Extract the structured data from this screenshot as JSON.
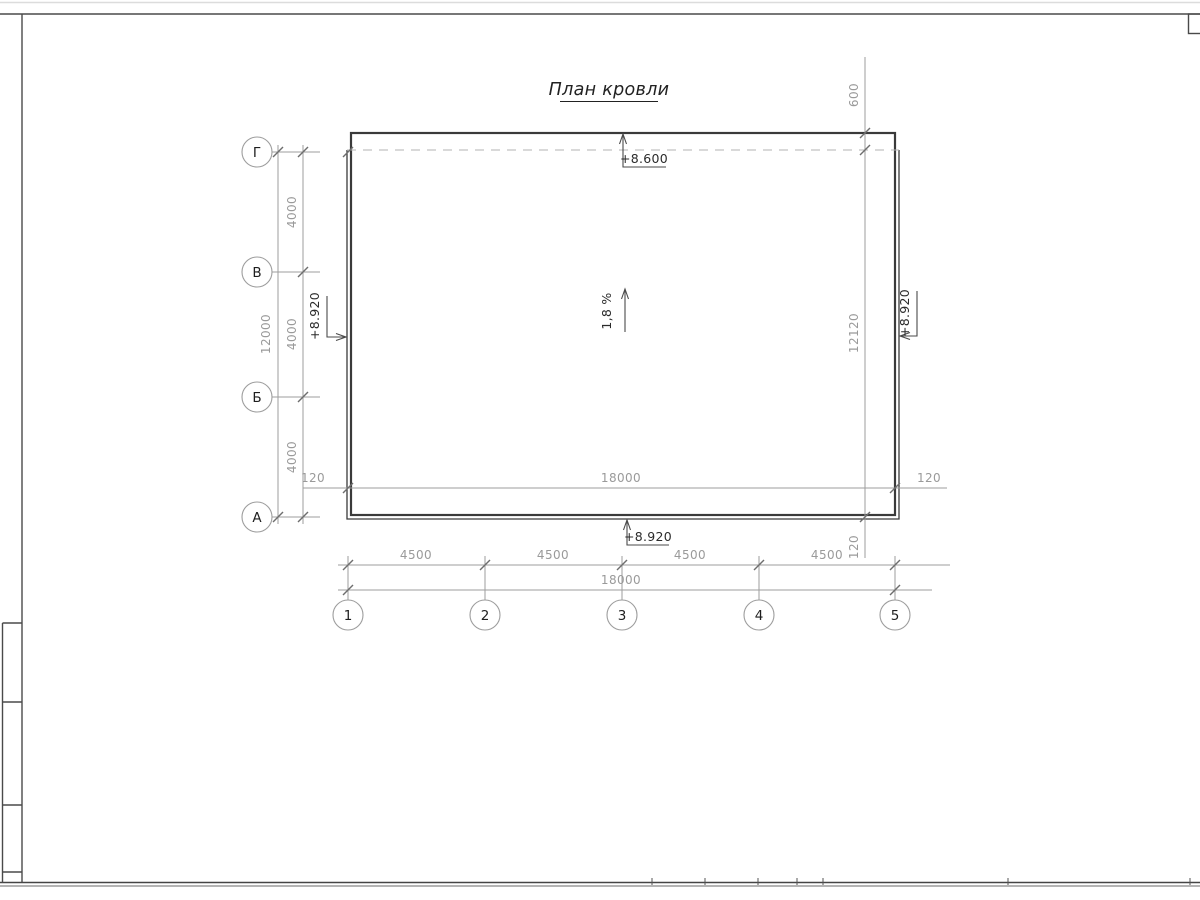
{
  "sheet": {
    "title": "План кровли"
  },
  "axes": {
    "rows": [
      "Г",
      "В",
      "Б",
      "А"
    ],
    "cols": [
      "1",
      "2",
      "3",
      "4",
      "5"
    ]
  },
  "dims": {
    "v_total": "12000",
    "v_seg": [
      "4000",
      "4000",
      "4000"
    ],
    "h_seg": [
      "4500",
      "4500",
      "4500",
      "4500"
    ],
    "h_total": "18000",
    "h_inner": "18000",
    "h_inner_left_off": "120",
    "h_inner_right_off": "120",
    "right_top": "600",
    "right_total": "12120",
    "right_bottom_off": "120"
  },
  "marks": {
    "top_elevation": "+8.600",
    "bottom_elevation": "+8.920",
    "left_elevation": "+8.920",
    "right_elevation": "+8.920",
    "slope": "1,8 %"
  }
}
